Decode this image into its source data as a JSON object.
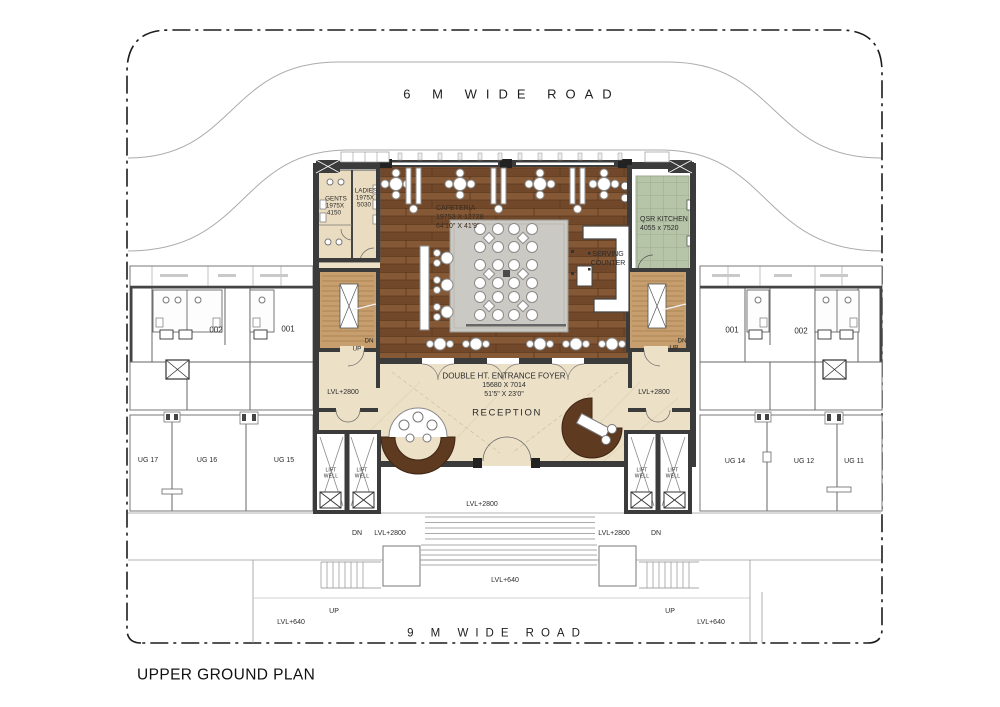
{
  "title": "UPPER GROUND PLAN",
  "roads": {
    "top": "6 M WIDE ROAD",
    "bottom": "9 M WIDE ROAD"
  },
  "cafeteria": {
    "name": "CAFETERIA",
    "mm": "19753 X 12728",
    "ft": "64'10\" X 41'9\""
  },
  "qsr": {
    "name": "QSR KITCHEN",
    "mm": "4055 x 7520"
  },
  "gents": {
    "name": "GENTS",
    "mm1": "1975X",
    "mm2": "4150"
  },
  "ladies": {
    "name": "LADIES",
    "mm1": "1975X",
    "mm2": "5030"
  },
  "serving": {
    "l1": "SERVING",
    "l2": "COUNTER"
  },
  "foyer": {
    "name": "DOUBLE HT. ENTRANCE FOYER",
    "mm": "15680 X 7014",
    "ft": "51'5\" X 23'0\""
  },
  "reception": "RECEPTION",
  "lift": {
    "l1": "LIFT",
    "l2": "WELL"
  },
  "stairs": {
    "dn": "DN",
    "up": "UP"
  },
  "levels": {
    "lvl2800": "LVL+2800",
    "lvl640": "LVL+640"
  },
  "units": {
    "left_wing": {
      "u1": "002",
      "u2": "001"
    },
    "right_wing": {
      "u1": "001",
      "u2": "002"
    },
    "bottom_left": {
      "u1": "UG 17",
      "u2": "UG 16",
      "u3": "UG 15"
    },
    "bottom_right": {
      "u1": "UG 14",
      "u2": "UG 12",
      "u3": "UG 11"
    }
  },
  "colors": {
    "wall": "#3b3b3b",
    "wood_floor": "#7a4e2c",
    "stair_wood": "#c79f6f",
    "marble_beige": "#ece0c7",
    "toilet_beige": "#eadcc0",
    "kitchen_tile_green": "#b6c4a8",
    "carpet_gray": "#cbc9c3",
    "desk_brown": "#5d3a20",
    "line_gray": "#8a8a8a"
  }
}
